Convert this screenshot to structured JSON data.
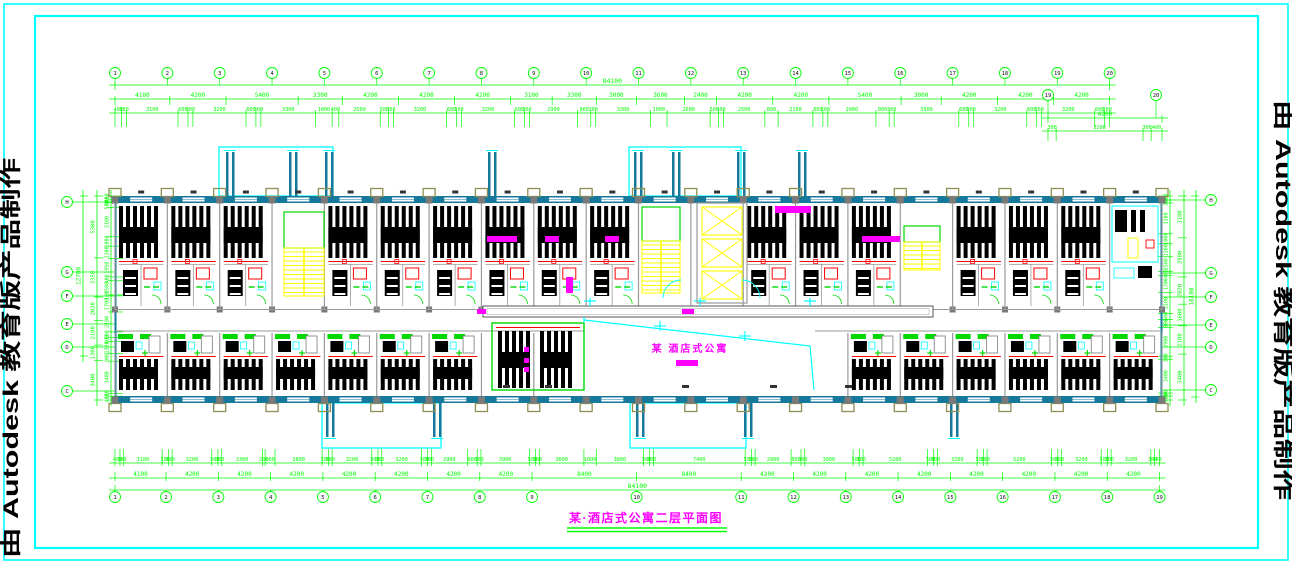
{
  "sheet": {
    "width": 1292,
    "height": 564,
    "bg": "#ffffff"
  },
  "frame": {
    "color": "#00ffff"
  },
  "watermark": {
    "text": "由 Autodesk 教育版产品制作"
  },
  "title_block": {
    "text": "某·酒店式公寓二层平面图"
  },
  "lobby": {
    "label": "某  酒店式公寓"
  },
  "colors": {
    "dim": "#00ff00",
    "green2": "#00d800",
    "wall": "#16789b",
    "cyan": "#00ffff",
    "column": "#7a7a7a",
    "khaki": "#8e8e55",
    "stair": "#ffff00",
    "red": "#ff0000",
    "magenta": "#ff00ff",
    "room_line": "#9a9a9a",
    "furniture": "#000000",
    "tag": "#333333"
  },
  "dims": {
    "top_total": "84100",
    "top_major": [
      "4100",
      "4200",
      "5400",
      "3300",
      "4200",
      "4200",
      "4200",
      "3100",
      "3300",
      "3000",
      "3600",
      "2400",
      "4200",
      "4200",
      "5400",
      "3000",
      "4200",
      "4200",
      "4200"
    ],
    "top_minor": [
      "400",
      "300",
      "3100",
      "600",
      "300",
      "3200",
      "600",
      "300",
      "3300",
      "1000",
      "400",
      "2500",
      "500",
      "300",
      "3200",
      "600",
      "300",
      "3200",
      "600",
      "300",
      "2900",
      "800",
      "300",
      "3300",
      "1000",
      "2600",
      "500",
      "300",
      "2500",
      "800",
      "2100",
      "600",
      "300",
      "2900",
      "800",
      "300",
      "3900",
      "600",
      "300",
      "3200",
      "600",
      "300",
      "3200",
      "600",
      "300"
    ],
    "top_right_major": [
      "4200"
    ],
    "top_right_minor": [
      "300",
      "3200",
      "300",
      "400"
    ],
    "bottom_total": "84100",
    "bottom_major": [
      "4100",
      "4200",
      "4200",
      "4200",
      "4200",
      "4200",
      "4200",
      "4200",
      "8400",
      "8400",
      "4200",
      "4200",
      "4200",
      "4200",
      "4200",
      "4200",
      "4200",
      "4200"
    ],
    "bottom_minor": [
      "400",
      "300",
      "3100",
      "500",
      "300",
      "3200",
      "500",
      "300",
      "3300",
      "200",
      "800",
      "3800",
      "500",
      "300",
      "3200",
      "500",
      "300",
      "3200",
      "500",
      "300",
      "2900",
      "800",
      "300",
      "3900",
      "500",
      "300",
      "3600",
      "1000",
      "3800",
      "500",
      "300",
      "7400",
      "500",
      "300",
      "2900",
      "800",
      "300",
      "3900",
      "500",
      "300",
      "5200",
      "500",
      "300",
      "3200",
      "500",
      "300",
      "5200",
      "500",
      "300",
      "3200",
      "500",
      "300",
      "3200",
      "300",
      "400"
    ],
    "left_total": "12700",
    "left_major": [
      "5300",
      "3350",
      "2020",
      "2100",
      "1300",
      "3400"
    ],
    "left_minor": [
      "400",
      "300",
      "500",
      "3100",
      "1000",
      "1300",
      "1950",
      "400",
      "1500",
      "100",
      "1700",
      "2100",
      "600",
      "400",
      "1300",
      "800",
      "3400",
      "300",
      "400"
    ],
    "right_total": "16100",
    "right_major": [
      "3100",
      "2900",
      "2020",
      "1600",
      "2100",
      "3400"
    ],
    "right_minor": [
      "400",
      "300",
      "3100",
      "1000",
      "1300",
      "1500",
      "400",
      "1700",
      "2100",
      "600",
      "800",
      "2900",
      "300",
      "3400",
      "300",
      "400"
    ]
  },
  "axes": {
    "top": [
      "1",
      "2",
      "3",
      "4",
      "5",
      "6",
      "7",
      "8",
      "9",
      "10",
      "11",
      "12",
      "13",
      "14",
      "15",
      "16",
      "17",
      "18",
      "19",
      "20"
    ],
    "bottom": [
      "1",
      "2",
      "3",
      "4",
      "5",
      "6",
      "7",
      "8",
      "9",
      "10",
      "11",
      "12",
      "13",
      "14",
      "15",
      "16",
      "17",
      "18",
      "19"
    ],
    "drop": [
      "19",
      "20"
    ],
    "left": [
      "H",
      "G",
      "F",
      "E",
      "D",
      "C"
    ],
    "right": [
      "H",
      "G",
      "F",
      "E",
      "D",
      "C"
    ]
  }
}
